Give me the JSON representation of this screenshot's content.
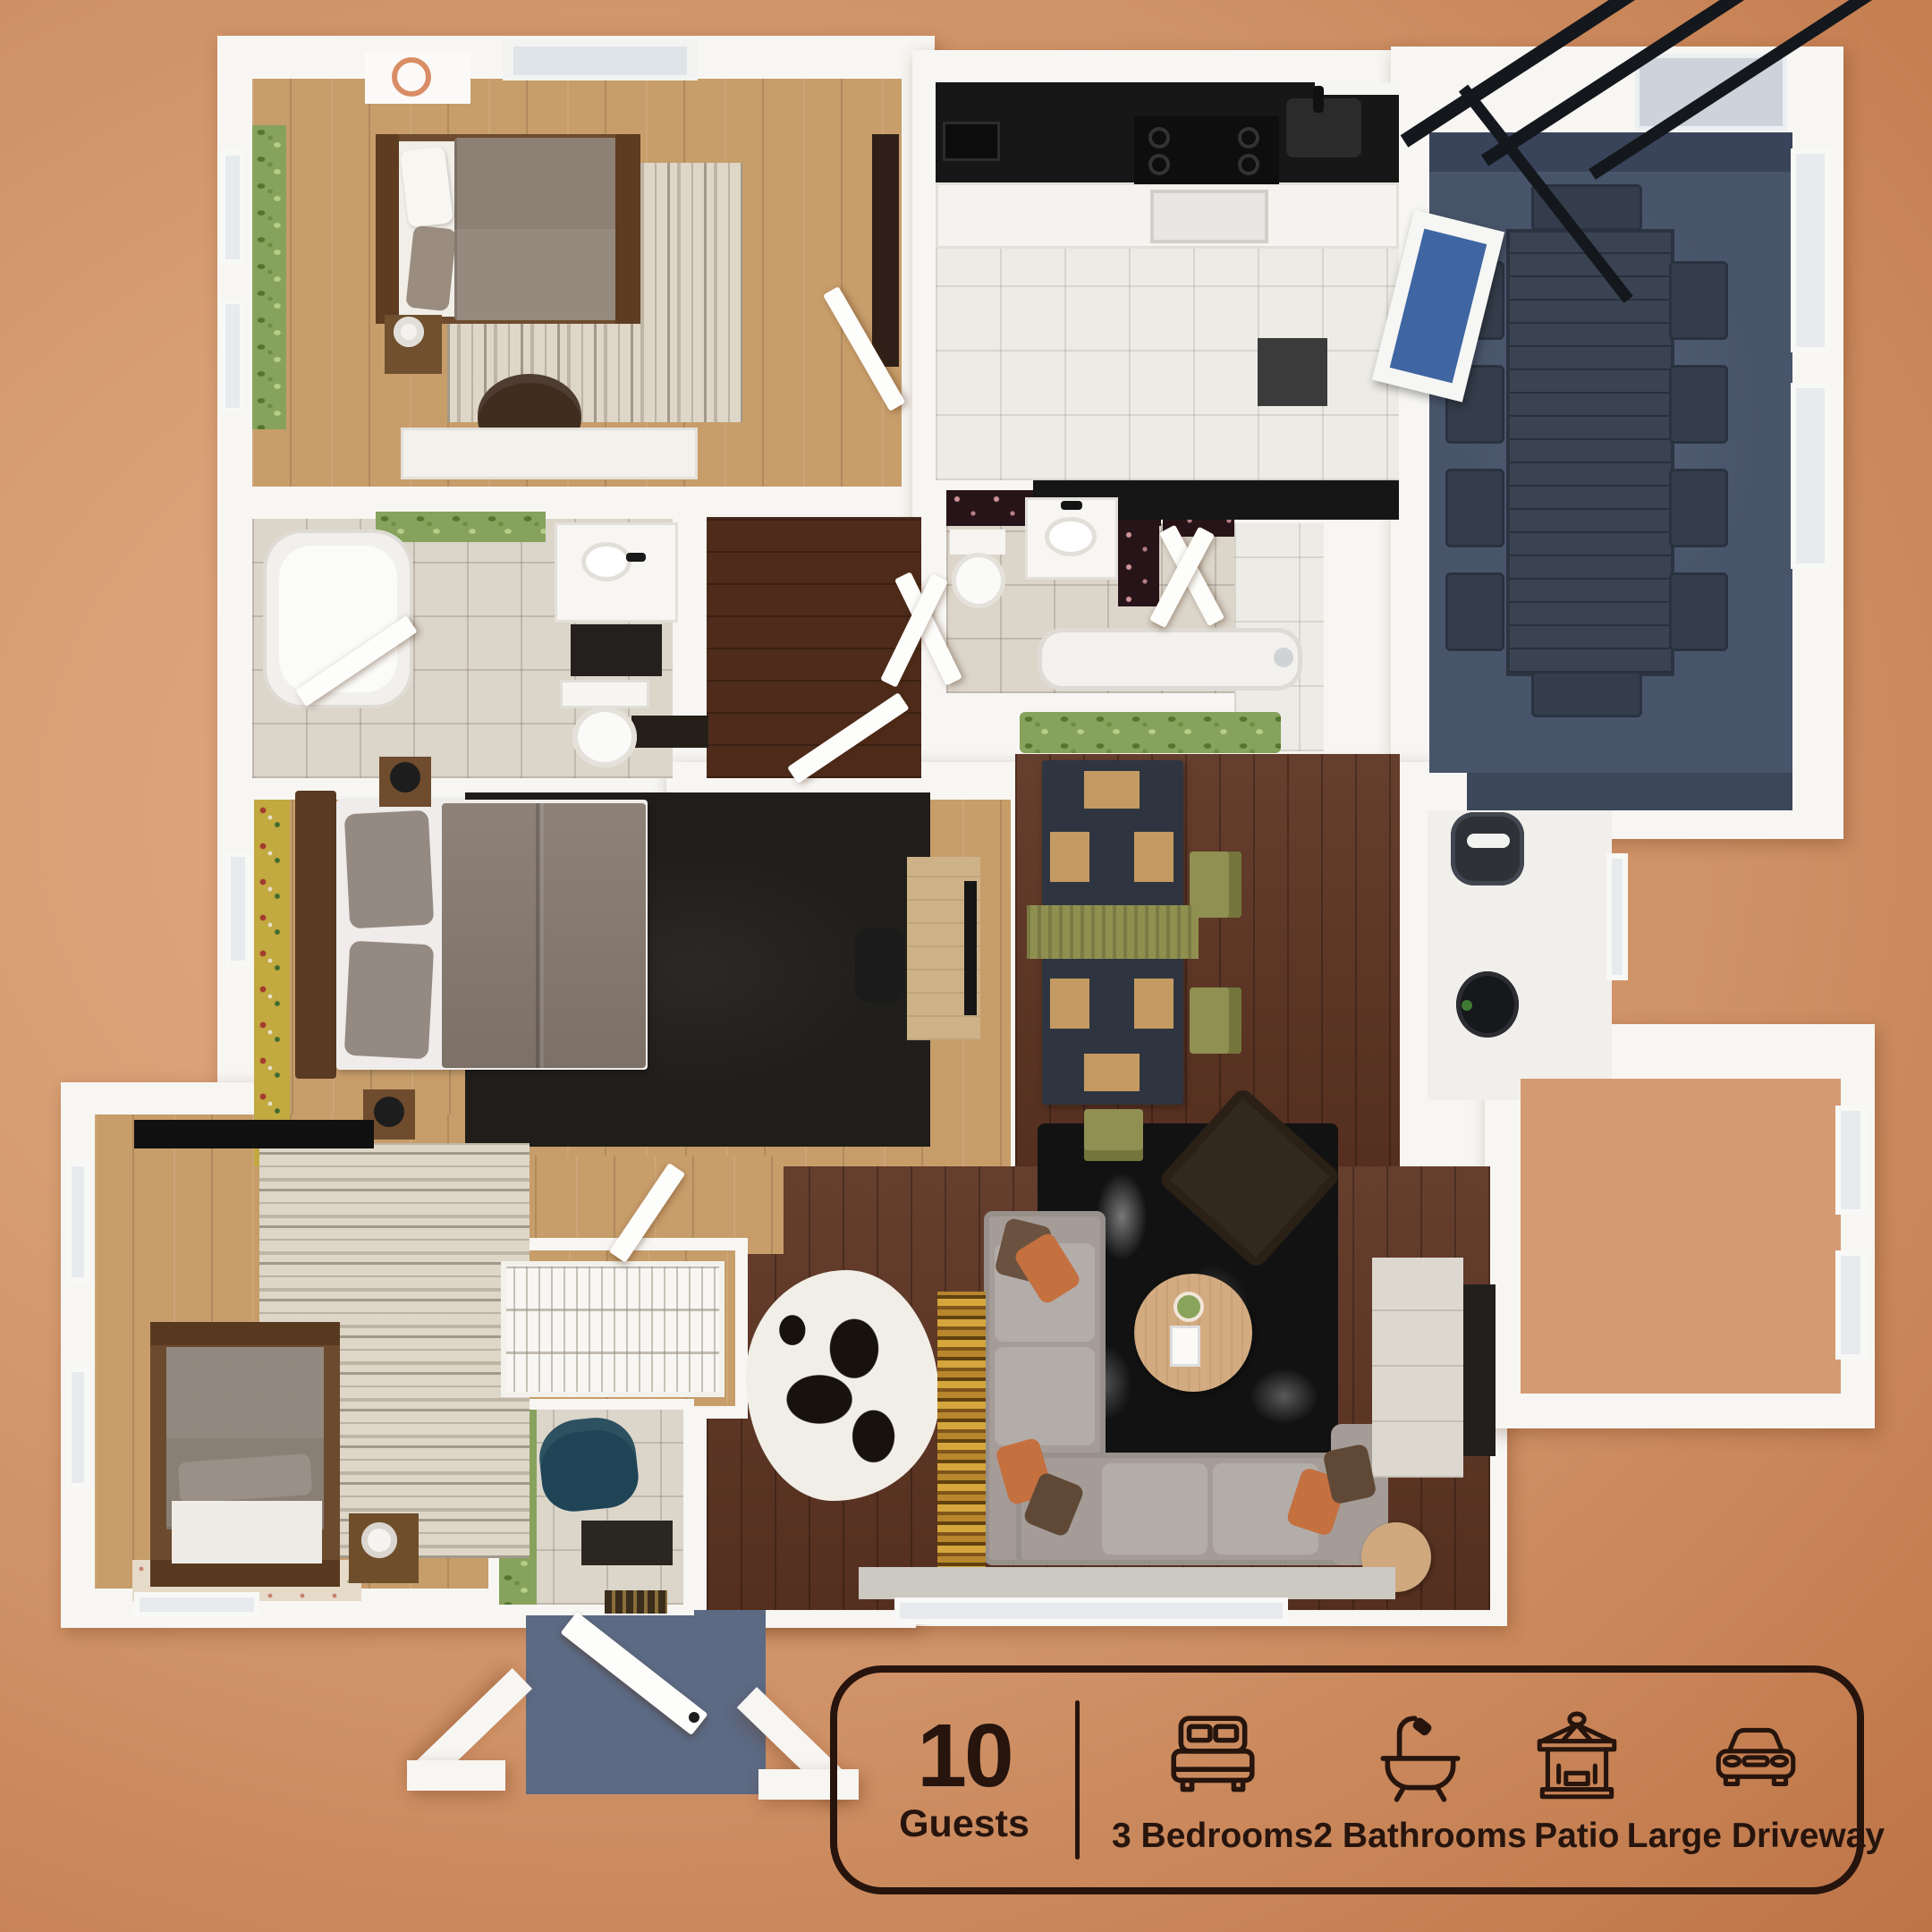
{
  "card": {
    "guests_value": "10",
    "guests_label": "Guests",
    "features": [
      {
        "icon": "bed-icon",
        "label": "3 Bedrooms"
      },
      {
        "icon": "bathtub-icon",
        "label": "2 Bathrooms"
      },
      {
        "icon": "gazebo-icon",
        "label": "Patio"
      },
      {
        "icon": "car-icon",
        "label": "Large Driveway"
      }
    ],
    "text_color": "#26140d"
  },
  "palette": {
    "background_center": "#e0ab84",
    "background_edge": "#a5562e",
    "wall_white": "#f7f6f3",
    "wood_light": "#c79d6a",
    "wood_dark": "#5e3422",
    "patio_floor": "#48546a",
    "porch_floor": "#5c6a84",
    "rug_black": "#201e1b",
    "sofa_gray": "#a59c97",
    "pillow_orange": "#c4703f",
    "pillow_brown": "#6b5240",
    "dining_chair_olive": "#8f9052",
    "armchair_teal": "#1e4456",
    "wallpaper_green": "#87a25c",
    "wallpaper_floral_dark": "#271419",
    "counter_black": "#171717",
    "card_outline": "#26140d"
  }
}
